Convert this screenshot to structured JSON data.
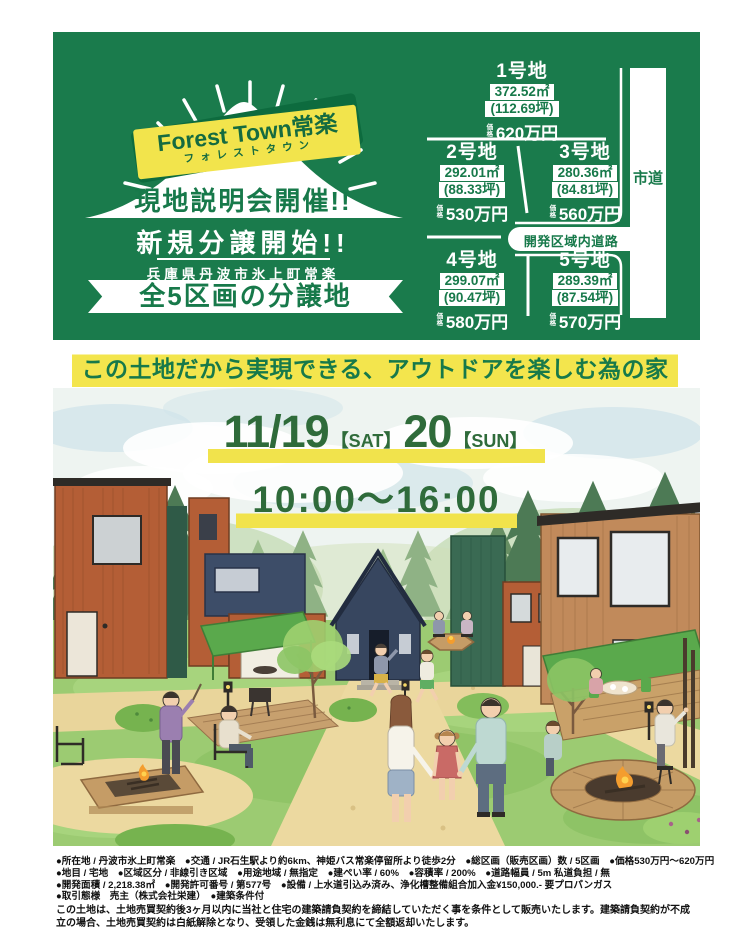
{
  "header": {
    "ribbon_title": "Forest Town常楽",
    "ribbon_subtitle": "フォレストタウン",
    "event_title": "現地説明会開催!!",
    "sale_start": "新規分譲開始!!",
    "address": "兵庫県丹波市氷上町常楽",
    "lots_banner": "全5区画の分譲地"
  },
  "map": {
    "price_label": "価格",
    "city_road": "市道",
    "inner_road": "開発区域内道路",
    "lots": [
      {
        "name": "1号地",
        "area_m2": "372.52㎡",
        "area_tsubo": "(112.69坪)",
        "price": "620万円"
      },
      {
        "name": "2号地",
        "area_m2": "292.01㎡",
        "area_tsubo": "(88.33坪)",
        "price": "530万円"
      },
      {
        "name": "3号地",
        "area_m2": "280.36㎡",
        "area_tsubo": "(84.81坪)",
        "price": "560万円"
      },
      {
        "name": "4号地",
        "area_m2": "299.07㎡",
        "area_tsubo": "(90.47坪)",
        "price": "580万円"
      },
      {
        "name": "5号地",
        "area_m2": "289.39㎡",
        "area_tsubo": "(87.54坪)",
        "price": "570万円"
      }
    ]
  },
  "catchcopy": "この土地だから実現できる、アウトドアを楽しむ為の家",
  "event_dates": {
    "date1": "11/19",
    "day1": "【SAT】",
    "date2": "20",
    "day2": "【SUN】",
    "time": "10:00〜16:00"
  },
  "colors": {
    "brand_green": "#1a7b4c",
    "accent_yellow": "#f2e44c",
    "date_green": "#2f6b3a"
  },
  "legal": {
    "lines": [
      "●所在地 / 丹波市氷上町常楽　●交通 / JR石生駅より約6km、神姫バス常楽停留所より徒歩2分　●総区画（販売区画）数 / 5区画　●価格530万円〜620万円",
      "●地目 / 宅地　●区域区分 / 非線引き区域　●用途地域 / 無指定　●建ぺい率 / 60%　●容積率 / 200%　●道路幅員 / 5m 私道負担 / 無",
      "●開発面積 / 2,218.38㎡　●開発許可番号 / 第577号　●設備 / 上水道引込み済み、浄化槽整備組合加入金¥150,000.- 要プロパンガス",
      "●取引態様　売主（株式会社栄建）　●建築条件付"
    ],
    "notice": "この土地は、土地売買契約後3ヶ月以内に当社と住宅の建築請負契約を締結していただく事を条件として販売いたします。建築請負契約が不成立の場合、土地売買契約は白紙解除となり、受領した金銭は無利息にて全額返却いたします。"
  }
}
